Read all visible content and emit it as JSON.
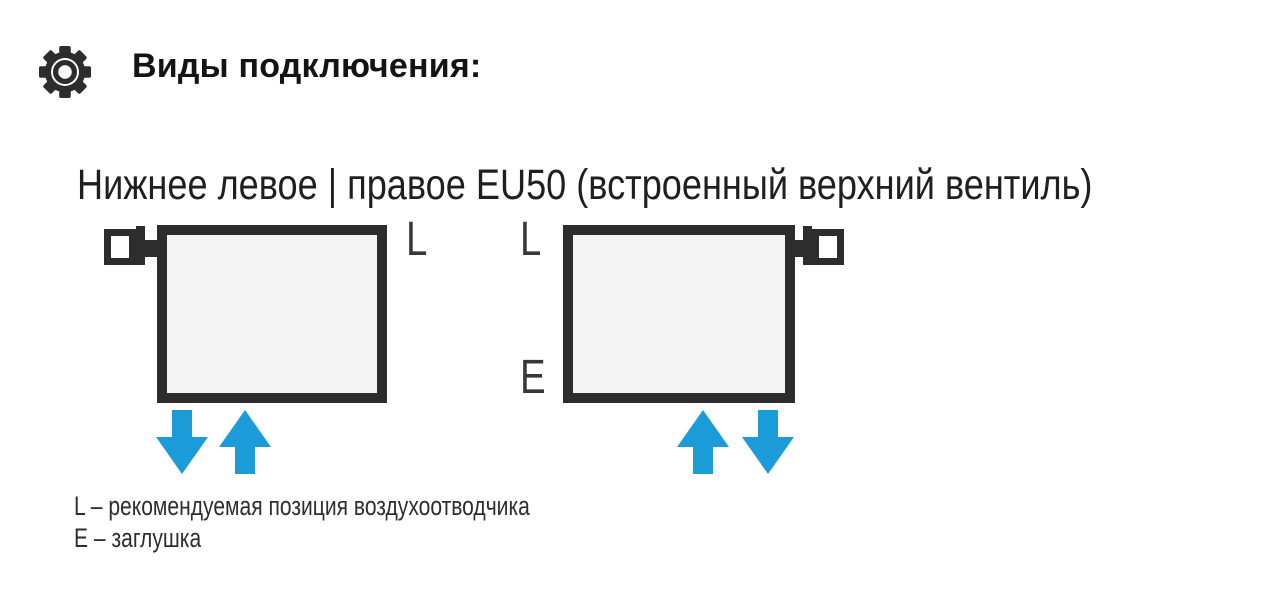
{
  "header": {
    "icon": "gear-icon",
    "title": "Виды подключения:"
  },
  "subtitle": "Нижнее левое | правое EU50 (встроенный верхний вентиль)",
  "diagrams": [
    {
      "name": "bottom-left-connection",
      "valve_side": "top-left",
      "labels": {
        "top_right": "L"
      },
      "arrows": [
        "down",
        "up"
      ],
      "arrows_position": "bottom-left"
    },
    {
      "name": "bottom-right-connection",
      "valve_side": "top-right",
      "labels": {
        "top_left": "L",
        "bottom_left": "E"
      },
      "arrows": [
        "up",
        "down"
      ],
      "arrows_position": "bottom-right"
    }
  ],
  "legend": [
    "L – рекомендуемая позиция воздухоотводчика",
    "E – заглушка"
  ],
  "colors": {
    "outline_dark": "#2d2d2d",
    "arrow_blue": "#1b9cd8",
    "radiator_fill": "#f4f4f4",
    "label_gray": "#383838",
    "background": "#ffffff"
  }
}
